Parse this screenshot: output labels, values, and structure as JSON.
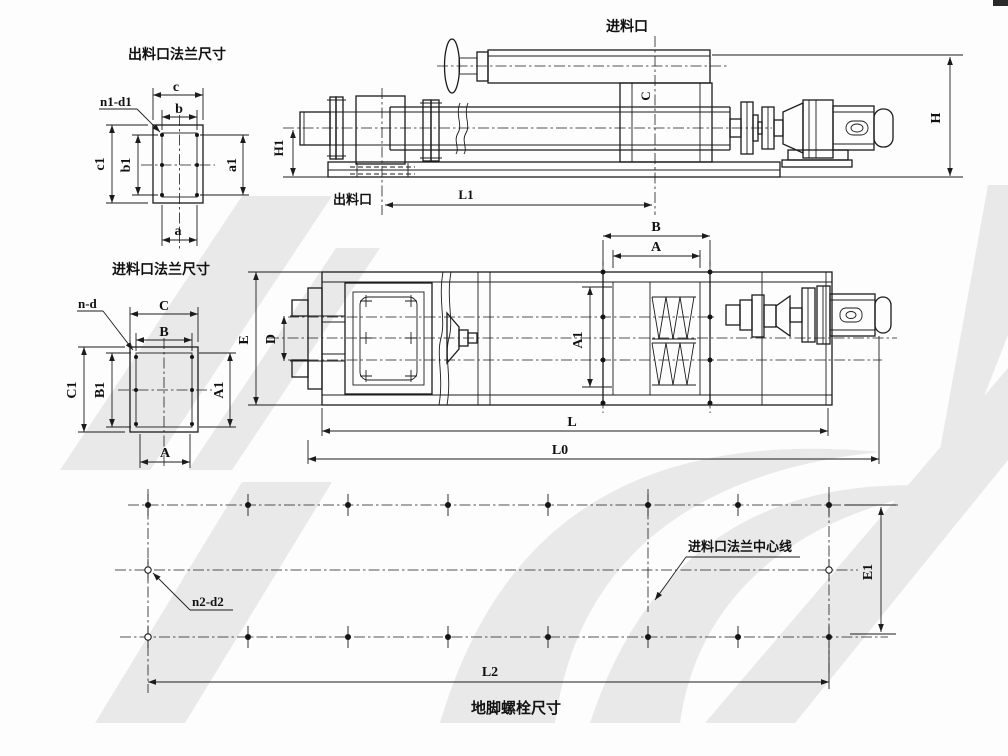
{
  "outlet_flange": {
    "title": "出料口法兰尺寸",
    "bolt_callout": "n1-d1",
    "dim_c": "c",
    "dim_b": "b",
    "dim_c1": "c1",
    "dim_b1": "b1",
    "dim_a1": "a1",
    "dim_a": "a"
  },
  "inlet_flange": {
    "title": "进料口法兰尺寸",
    "bolt_callout": "n-d",
    "dim_C": "C",
    "dim_B": "B",
    "dim_C1": "C1",
    "dim_B1": "B1",
    "dim_A1": "A1",
    "dim_A": "A"
  },
  "side_view": {
    "inlet_label": "进料口",
    "outlet_label": "出料口",
    "dim_H": "H",
    "dim_H1": "H1",
    "dim_L1": "L1",
    "dim_C": "C"
  },
  "plan_view": {
    "dim_B": "B",
    "dim_A": "A",
    "dim_E": "E",
    "dim_D": "D",
    "dim_A1": "A1",
    "dim_L": "L",
    "dim_L0": "L0"
  },
  "foundation_plan": {
    "title": "地脚螺栓尺寸",
    "bolt_callout": "n2-d2",
    "centerline_label": "进料口法兰中心线",
    "dim_E1": "E1",
    "dim_L2": "L2"
  }
}
